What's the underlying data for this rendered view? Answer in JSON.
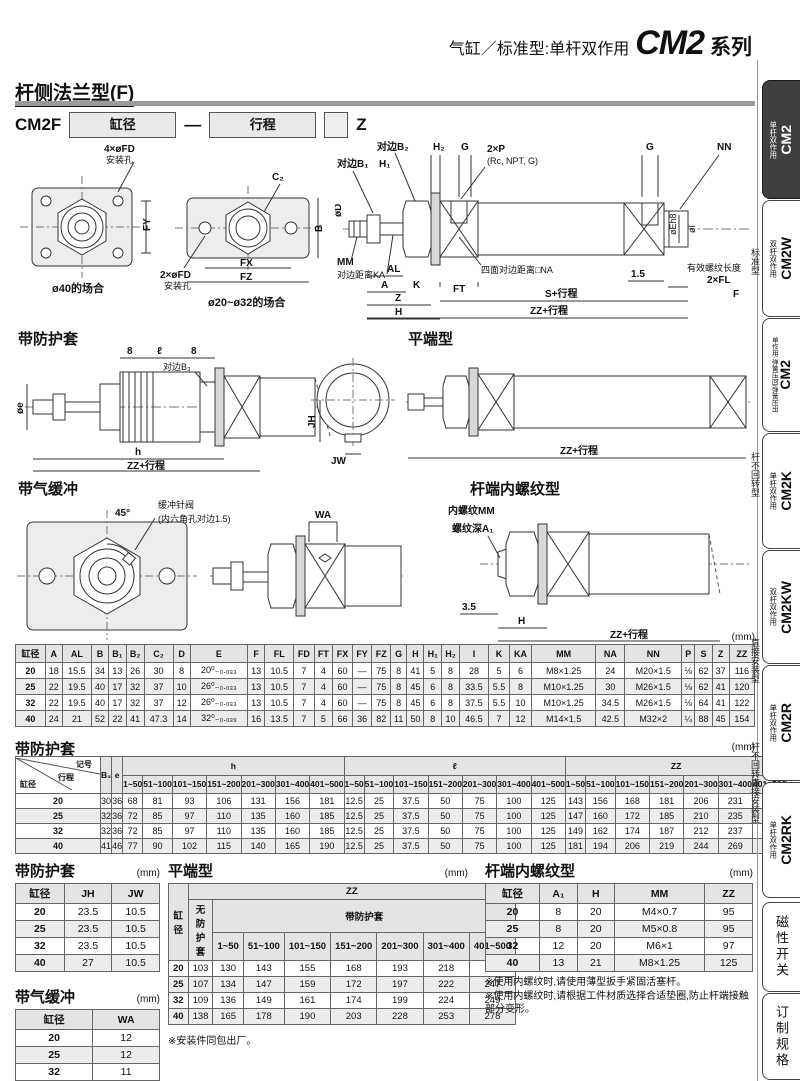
{
  "header": {
    "left": "气缸／标准型:单杆双作用",
    "model": "CM2",
    "right": "系列"
  },
  "section": {
    "title": "杆侧法兰型(F)"
  },
  "model_code": {
    "prefix": "CM2F",
    "bore": "缸径",
    "dash": "—",
    "stroke": "行程",
    "suffix": "Z"
  },
  "drawings": {
    "flange40": {
      "holes": "4×øFD",
      "holes_sub": "安装孔",
      "fy": "FY",
      "caption": "ø40的场合"
    },
    "flange2032": {
      "c2": "C₂",
      "holes": "2×øFD",
      "holes_sub": "安装孔",
      "fx": "FX",
      "fz": "FZ",
      "b": "B",
      "caption": "ø20~ø32的场合"
    },
    "main": {
      "b2": "对边B₂",
      "h2": "H₂",
      "g1": "G",
      "p": "2×P",
      "p_sub": "(Rc, NPT, G)",
      "g2": "G",
      "nn": "NN",
      "b1": "对边B₁",
      "h1": "H₁",
      "d": "øD",
      "mm": "MM",
      "ka": "对边距离KA",
      "al": "AL",
      "a": "A",
      "k": "K",
      "z": "Z",
      "h": "H",
      "ft": "FT",
      "na": "四面对边距离□NA",
      "dim15": "1.5",
      "thread_len": "有效螺纹长度",
      "fl": "2×FL",
      "e": "øEh8",
      "i": "øI",
      "s": "S+行程",
      "f": "F",
      "zz": "ZZ+行程"
    },
    "boot": {
      "title": "带防护套",
      "d8a": "8",
      "l": "ℓ",
      "d8b": "8",
      "b3": "对边B₃",
      "e": "øe",
      "h": "h",
      "zz": "ZZ+行程",
      "jh": "JH",
      "jw": "JW"
    },
    "flat": {
      "title": "平端型",
      "zz": "ZZ+行程"
    },
    "cushion": {
      "title": "带气缓冲",
      "angle": "45°",
      "needle": "缓冲针阀",
      "needle_sub": "(内六角孔对边1.5)",
      "wa": "WA"
    },
    "female": {
      "title": "杆端内螺纹型",
      "mm": "内螺纹MM",
      "a1": "螺纹深A₁",
      "dim35": "3.5",
      "h": "H",
      "zz": "ZZ+行程"
    }
  },
  "dim_table": {
    "unit": "(mm)",
    "headers": [
      "缸径",
      "A",
      "AL",
      "B",
      "B₁",
      "B₂",
      "C₂",
      "D",
      "E",
      "F",
      "FL",
      "FD",
      "FT",
      "FX",
      "FY",
      "FZ",
      "G",
      "H",
      "H₁",
      "H₂",
      "I",
      "K",
      "KA",
      "MM",
      "NA",
      "NN",
      "P",
      "S",
      "Z",
      "ZZ"
    ],
    "rows": [
      [
        "20",
        "18",
        "15.5",
        "34",
        "13",
        "26",
        "30",
        "8",
        "20⁰₋₀.₀₃₃",
        "13",
        "10.5",
        "7",
        "4",
        "60",
        "—",
        "75",
        "8",
        "41",
        "5",
        "8",
        "28",
        "5",
        "6",
        "M8×1.25",
        "24",
        "M20×1.5",
        "⅛",
        "62",
        "37",
        "116"
      ],
      [
        "25",
        "22",
        "19.5",
        "40",
        "17",
        "32",
        "37",
        "10",
        "26⁰₋₀.₀₃₃",
        "13",
        "10.5",
        "7",
        "4",
        "60",
        "—",
        "75",
        "8",
        "45",
        "6",
        "8",
        "33.5",
        "5.5",
        "8",
        "M10×1.25",
        "30",
        "M26×1.5",
        "⅛",
        "62",
        "41",
        "120"
      ],
      [
        "32",
        "22",
        "19.5",
        "40",
        "17",
        "32",
        "37",
        "12",
        "26⁰₋₀.₀₃₃",
        "13",
        "10.5",
        "7",
        "4",
        "60",
        "—",
        "75",
        "8",
        "45",
        "6",
        "8",
        "37.5",
        "5.5",
        "10",
        "M10×1.25",
        "34.5",
        "M26×1.5",
        "⅛",
        "64",
        "41",
        "122"
      ],
      [
        "40",
        "24",
        "21",
        "52",
        "22",
        "41",
        "47.3",
        "14",
        "32⁰₋₀.₀₃₉",
        "16",
        "13.5",
        "7",
        "5",
        "66",
        "36",
        "82",
        "11",
        "50",
        "8",
        "10",
        "46.5",
        "7",
        "12",
        "M14×1.5",
        "42.5",
        "M32×2",
        "¼",
        "88",
        "45",
        "154"
      ]
    ]
  },
  "boot_table": {
    "title": "带防护套",
    "unit": "(mm)",
    "corner": {
      "tr": "记号",
      "mid": "行程",
      "bl": "缸径"
    },
    "b3": "B₃",
    "e": "e",
    "groups": [
      "h",
      "ℓ",
      "ZZ"
    ],
    "ranges": [
      "1~50",
      "51~100",
      "101~150",
      "151~200",
      "201~300",
      "301~400",
      "401~500"
    ],
    "rows": [
      [
        "20",
        "30",
        "36",
        "68",
        "81",
        "93",
        "106",
        "131",
        "156",
        "181",
        "12.5",
        "25",
        "37.5",
        "50",
        "75",
        "100",
        "125",
        "143",
        "156",
        "168",
        "181",
        "206",
        "231",
        "256"
      ],
      [
        "25",
        "32",
        "36",
        "72",
        "85",
        "97",
        "110",
        "135",
        "160",
        "185",
        "12.5",
        "25",
        "37.5",
        "50",
        "75",
        "100",
        "125",
        "147",
        "160",
        "172",
        "185",
        "210",
        "235",
        "260"
      ],
      [
        "32",
        "32",
        "36",
        "72",
        "85",
        "97",
        "110",
        "135",
        "160",
        "185",
        "12.5",
        "25",
        "37.5",
        "50",
        "75",
        "100",
        "125",
        "149",
        "162",
        "174",
        "187",
        "212",
        "237",
        "262"
      ],
      [
        "40",
        "41",
        "46",
        "77",
        "90",
        "102",
        "115",
        "140",
        "165",
        "190",
        "12.5",
        "25",
        "37.5",
        "50",
        "75",
        "100",
        "125",
        "181",
        "194",
        "206",
        "219",
        "244",
        "269",
        "294"
      ]
    ]
  },
  "boot_small_table": {
    "title": "带防护套",
    "unit": "(mm)",
    "headers": [
      "缸径",
      "JH",
      "JW"
    ],
    "rows": [
      [
        "20",
        "23.5",
        "10.5"
      ],
      [
        "25",
        "23.5",
        "10.5"
      ],
      [
        "32",
        "23.5",
        "10.5"
      ],
      [
        "40",
        "27",
        "10.5"
      ]
    ]
  },
  "cushion_table": {
    "title": "带气缓冲",
    "unit": "(mm)",
    "headers": [
      "缸径",
      "WA"
    ],
    "rows": [
      [
        "20",
        "12"
      ],
      [
        "25",
        "12"
      ],
      [
        "32",
        "11"
      ],
      [
        "40",
        "16"
      ]
    ]
  },
  "flat_table": {
    "title": "平端型",
    "unit": "(mm)",
    "bore": "缸径",
    "zz": "ZZ",
    "no_boot": "无防护套",
    "with_boot": "带防护套",
    "ranges": [
      "1~50",
      "51~100",
      "101~150",
      "151~200",
      "201~300",
      "301~400",
      "401~500"
    ],
    "rows": [
      [
        "20",
        "103",
        "130",
        "143",
        "155",
        "168",
        "193",
        "218",
        "243"
      ],
      [
        "25",
        "107",
        "134",
        "147",
        "159",
        "172",
        "197",
        "222",
        "247"
      ],
      [
        "32",
        "109",
        "136",
        "149",
        "161",
        "174",
        "199",
        "224",
        "249"
      ],
      [
        "40",
        "138",
        "165",
        "178",
        "190",
        "203",
        "228",
        "253",
        "278"
      ]
    ],
    "note": "※安装件同包出厂。"
  },
  "female_table": {
    "title": "杆端内螺纹型",
    "unit": "(mm)",
    "headers": [
      "缸径",
      "A₁",
      "H",
      "MM",
      "ZZ"
    ],
    "rows": [
      [
        "20",
        "8",
        "20",
        "M4×0.7",
        "95"
      ],
      [
        "25",
        "8",
        "20",
        "M5×0.8",
        "95"
      ],
      [
        "32",
        "12",
        "20",
        "M6×1",
        "97"
      ],
      [
        "40",
        "13",
        "21",
        "M8×1.25",
        "125"
      ]
    ],
    "notes": [
      "※使用内螺纹时,请使用薄型扳手紧固活塞杆。",
      "※使用内螺纹时,请根据工件材质选择合适垫圈,防止杆端接触部分变形。"
    ]
  },
  "sidebar": {
    "tabs": [
      {
        "model": "CM2",
        "label": "单杆双作用"
      },
      {
        "model": "CM2W",
        "label": "双杆双作用"
      },
      {
        "model": "CM2",
        "label": "单作用·弹簧压回/弹簧压出"
      },
      {
        "model": "CM2K",
        "label": "单杆双作用"
      },
      {
        "model": "CM2KW",
        "label": "双杆双作用"
      },
      {
        "model": "CM2R",
        "label": "单杆双作用"
      },
      {
        "model": "CM2RK",
        "label": "单杆双作用"
      },
      {
        "text": "磁性开关"
      },
      {
        "text": "订制规格"
      }
    ],
    "groups": [
      "标准型",
      "杆不回转型",
      "直接安装型",
      "杆不回转直接安装型"
    ]
  }
}
